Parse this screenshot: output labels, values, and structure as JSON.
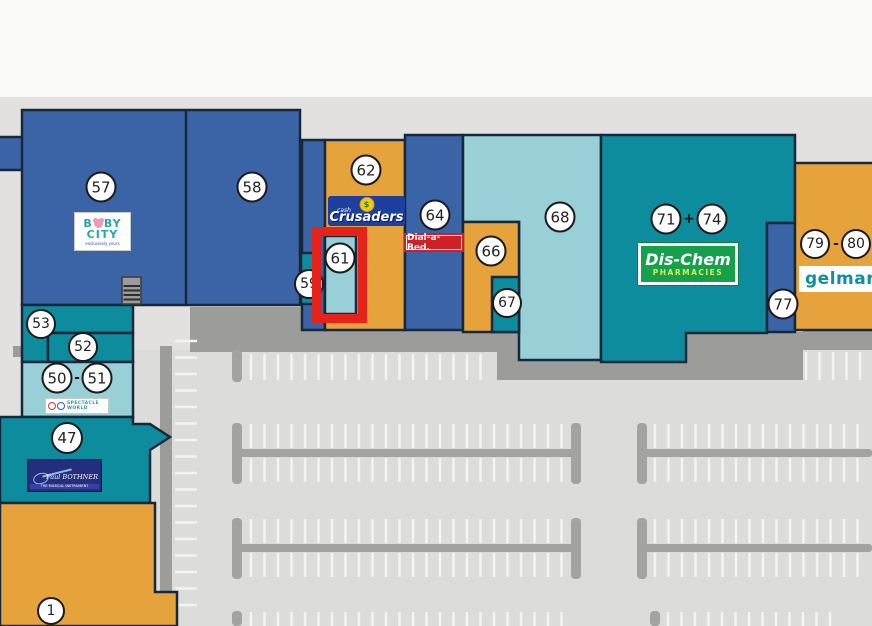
{
  "units": [
    {
      "id": "57",
      "label": "57"
    },
    {
      "id": "58",
      "label": "58"
    },
    {
      "id": "59",
      "label": "59"
    },
    {
      "id": "61",
      "label": "61"
    },
    {
      "id": "62",
      "label": "62"
    },
    {
      "id": "64",
      "label": "64"
    },
    {
      "id": "66",
      "label": "66"
    },
    {
      "id": "67",
      "label": "67"
    },
    {
      "id": "68",
      "label": "68"
    },
    {
      "id": "71",
      "label": "71"
    },
    {
      "id": "74",
      "label": "74"
    },
    {
      "id": "77",
      "label": "77"
    },
    {
      "id": "79",
      "label": "79"
    },
    {
      "id": "80",
      "label": "80"
    },
    {
      "id": "53",
      "label": "53"
    },
    {
      "id": "52",
      "label": "52"
    },
    {
      "id": "50",
      "label": "50"
    },
    {
      "id": "51",
      "label": "51"
    },
    {
      "id": "47",
      "label": "47"
    },
    {
      "id": "1",
      "label": "1"
    }
  ],
  "separators": {
    "pair_71_74": "+",
    "pair_79_80": "-",
    "pair_50_51": "-"
  },
  "highlight": {
    "unit": "61",
    "color": "#e5231b"
  },
  "logos": {
    "baby_city": {
      "l1a": "B",
      "l1b": "BY",
      "line2": "CITY",
      "tagline": "exclusively yours"
    },
    "cash_crusaders": {
      "emblem": "$",
      "top": "cash",
      "name": "Crusaders"
    },
    "dial_a_bed": {
      "name": "Dial-a-Bed."
    },
    "dis_chem": {
      "name": "Dis-Chem",
      "sub": "PHARMACIES"
    },
    "gelmar": {
      "name": "gelmar"
    },
    "spectacle_world": {
      "line1": "SPECTACLE",
      "line2": "WORLD"
    },
    "paul_bothner": {
      "name": "Paul BOTHNER",
      "tagline": "THE MUSICAL INSTRUMENT SPECIALISTS"
    }
  },
  "colors": {
    "top_band": "#fafaf8",
    "background": "#e2e1df",
    "parking": "#dcdddb",
    "road": "#9c9c9a",
    "parking_structure": "#a3a3a1",
    "dark_blue": "#3b64a6",
    "teal": "#0d8c9e",
    "pale_cyan": "#99cfd7",
    "orange": "#e6a33c",
    "stair_gray": "#9b9b99",
    "highlight_red": "#e5231b"
  }
}
